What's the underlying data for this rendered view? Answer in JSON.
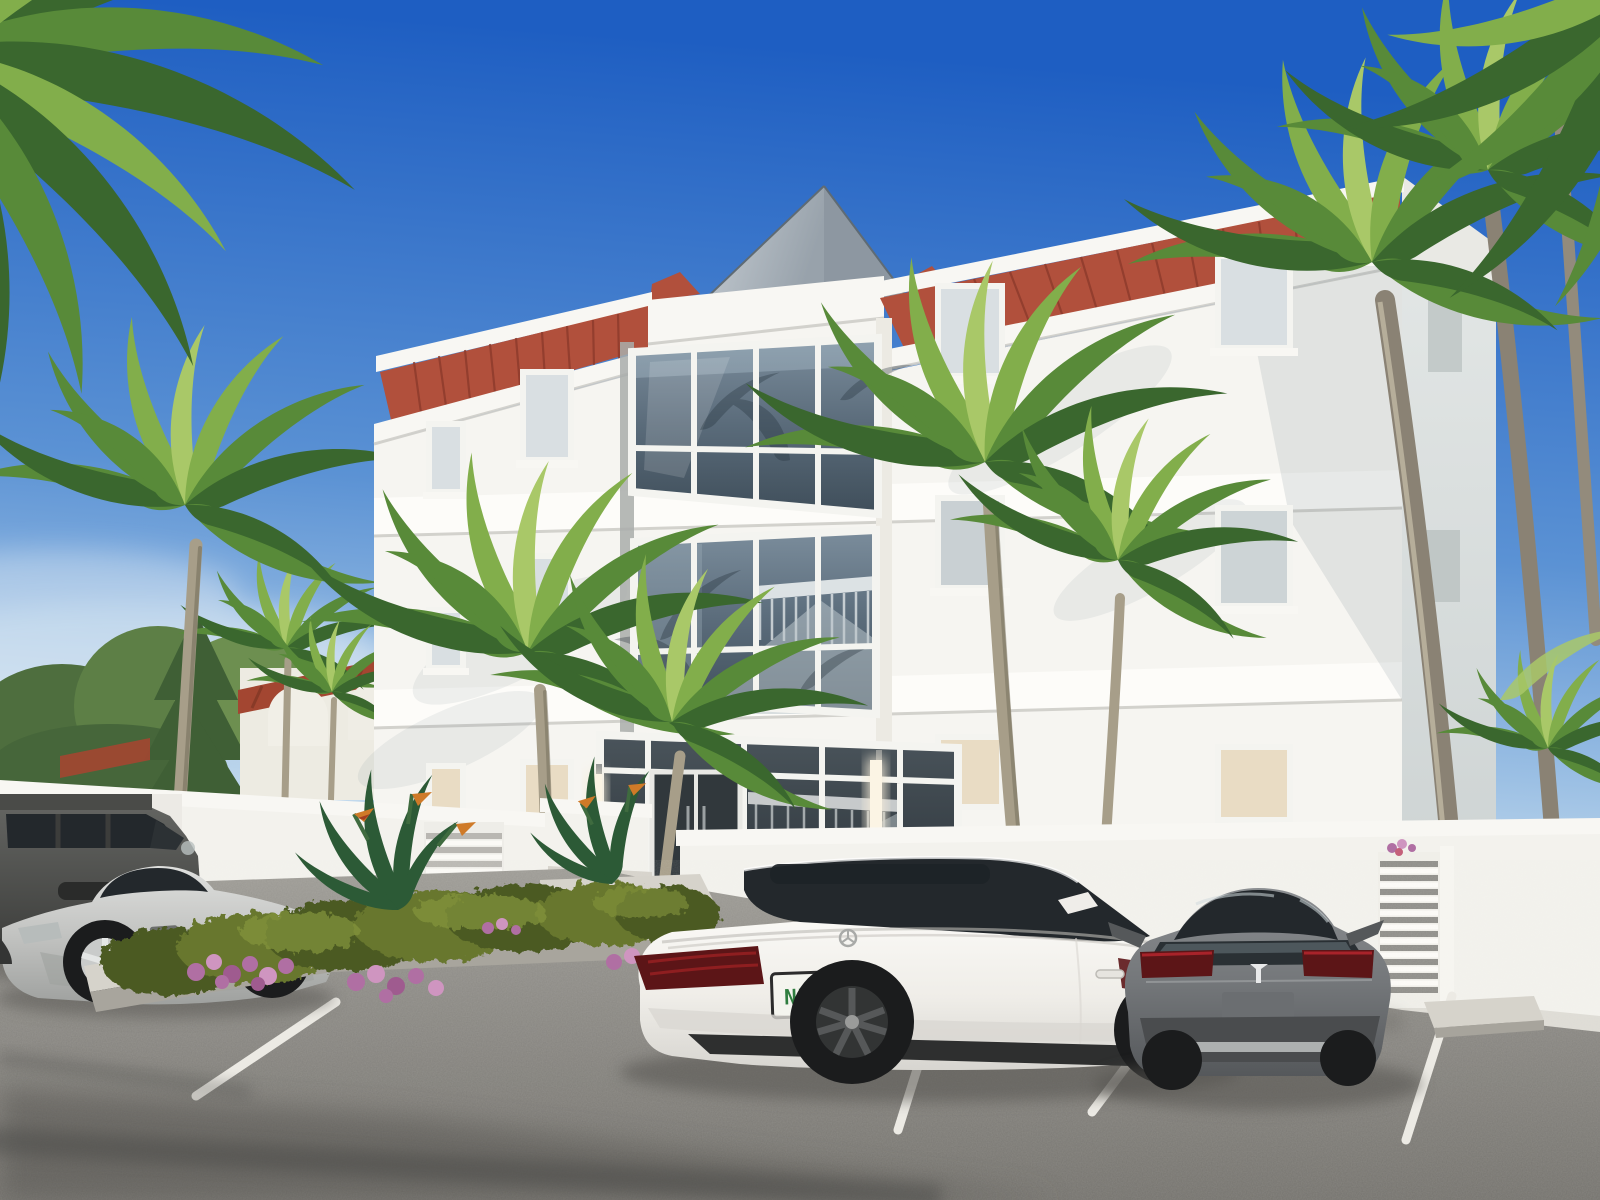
{
  "scene": {
    "type": "architectural exterior rendering",
    "description": "Three-story white coastal condominium with red standing-seam metal hip roof, central two-story glass bays, glass entry with interior staircase, white perimeter wall, tropical palms and landscaped parking lot with four parked cars",
    "time_of_day": "midday, clear blue sky",
    "lighting": "bright sun from upper left, long palm shadows across asphalt"
  },
  "palette": {
    "sky_top": "#1e5ec2",
    "sky_mid": "#5b92d4",
    "sky_soft": "#9cc0e4",
    "sky_low": "#c6dcee",
    "sky_horizon": "#e9f1f5",
    "facade_white": "#f6f5f1",
    "facade_bright": "#fdfcf9",
    "facade_side": "#d7dcdc",
    "band_shadow": "#cfcec9",
    "roof_red": "#b1503c",
    "roof_seam": "#8c3a2b",
    "fascia_white": "#f8f7f3",
    "pyramid_light": "#c9d0d6",
    "pyramid_dark": "#98a2ab",
    "glass_top": "#7b8d9c",
    "glass_mid": "#5a6b7a",
    "glass_bottom": "#3f4e5a",
    "glass_tint": "#23282c",
    "mullion": "#f4f4f0",
    "interior_warm": "#e9dcc4",
    "interior_pale": "#d9dfe2",
    "sconce_glow": "#f6edd9",
    "palm_dark": "#3a672e",
    "palm_mid": "#588a39",
    "palm_light": "#82ae4b",
    "palm_pale": "#a9c868",
    "trunk": "#a79e89",
    "trunk_dark": "#6c6554",
    "hedge_dark": "#4c5a22",
    "hedge_mid": "#67772e",
    "hedge_light": "#84953c",
    "bop_green": "#2c5a36",
    "bop_orange": "#cf7a28",
    "flower_pink": "#b06fa3",
    "flower_pink_light": "#cf95c0",
    "concrete": "#bcb9b1",
    "curb_light": "#d6d3cb",
    "wall_white": "#f3f2ed",
    "wall_base": "#dedcd5",
    "asphalt_light": "#9d9b95",
    "asphalt": "#8d8b86",
    "asphalt_dark": "#75736e",
    "shadow": "#54534f",
    "line_white": "#eceae4",
    "car_white": "#f1efeb",
    "car_silver": "#c7c8c6",
    "car_gray": "#74777a",
    "suv_graphite": "#4a4b48",
    "taillight": "#5c1517",
    "taillight_bright": "#a8232a",
    "wheel_dark": "#1b1c1d",
    "plate_green": "#2f7d3f",
    "plate_orange": "#e08a2c"
  },
  "building": {
    "floors": 3,
    "style": "coastal contemporary white stucco",
    "roof": "terracotta-red standing-seam metal hip roof with white fascia and cornice",
    "skylight": "gray pyramid roof peak at center",
    "glass_bays": 2,
    "entrance": "full-height glass storefront with double glass doors and visible interior staircase",
    "wall_sconces": 2,
    "window_columns": 4
  },
  "neighbor_building": {
    "style": "white villa with red clay tile roof and arched parapets, behind trees at left"
  },
  "site": {
    "perimeter_wall": "low white stucco wall with louvered gate panels",
    "planter_island": "concrete-curbed island with boxwood hedge, bird-of-paradise plants and pink flower patches",
    "entry_steps": 3,
    "parking_lines": 4,
    "palms": "royal palms flanking the facade, large fronds entering frame at top corners"
  },
  "vehicles": {
    "suv": {
      "description": "boxy graphite-gray luxury SUV",
      "view": "left edge of frame, beyond island"
    },
    "sports_car": {
      "description": "silver gullwing coupe, long hood",
      "view": "side profile facing left, beyond island"
    },
    "white_sedan": {
      "description": "white luxury sedan with dark alloy wheels and panoramic roof",
      "view": "rear three-quarter, center stall",
      "license_plate": {
        "left": "N7",
        "right": "2U",
        "style": "white plate with orange fruit graphic"
      }
    },
    "tesla": {
      "description": "warm-gray electric liftback with T badge",
      "view": "direct rear, right stall"
    }
  }
}
